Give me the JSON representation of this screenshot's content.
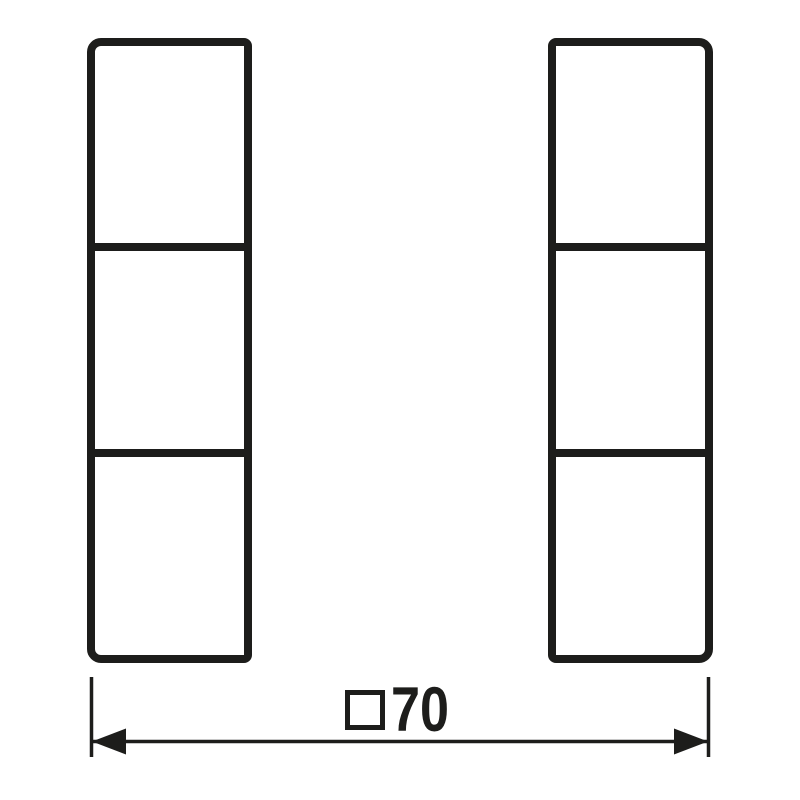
{
  "drawing": {
    "kind": "dimensional-drawing",
    "colors": {
      "stroke": "#1d1d1b",
      "background": "#ffffff"
    },
    "columns": [
      {
        "name": "left-column",
        "segments": 3
      },
      {
        "name": "right-column",
        "segments": 3
      }
    ],
    "dimension": {
      "symbol_icon": "square-outline-icon",
      "value": "70",
      "full_label": "□70"
    }
  }
}
